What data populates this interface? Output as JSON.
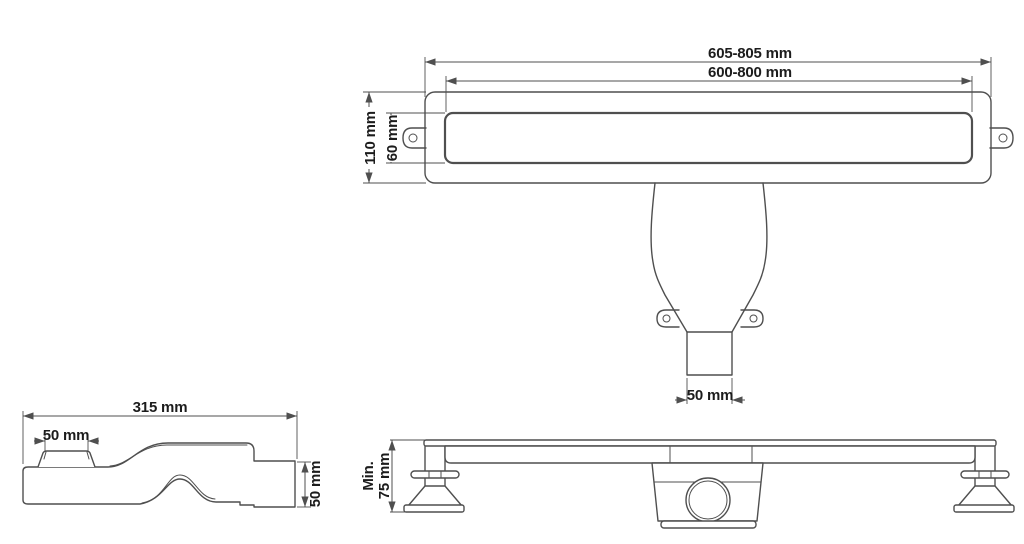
{
  "colors": {
    "line": "#4f4f4f",
    "text": "#1c1c1c",
    "background": "#ffffff"
  },
  "top_view": {
    "outer_length": "605-805 mm",
    "cutout_length": "600-800 mm",
    "body_width": "110 mm",
    "grate_width": "60 mm",
    "outlet_width": "50 mm"
  },
  "side_view": {
    "length": "315 mm",
    "inlet_width": "50 mm",
    "outlet_height": "50 mm"
  },
  "front_view": {
    "min_label": "Min.",
    "min_height": "75 mm"
  }
}
